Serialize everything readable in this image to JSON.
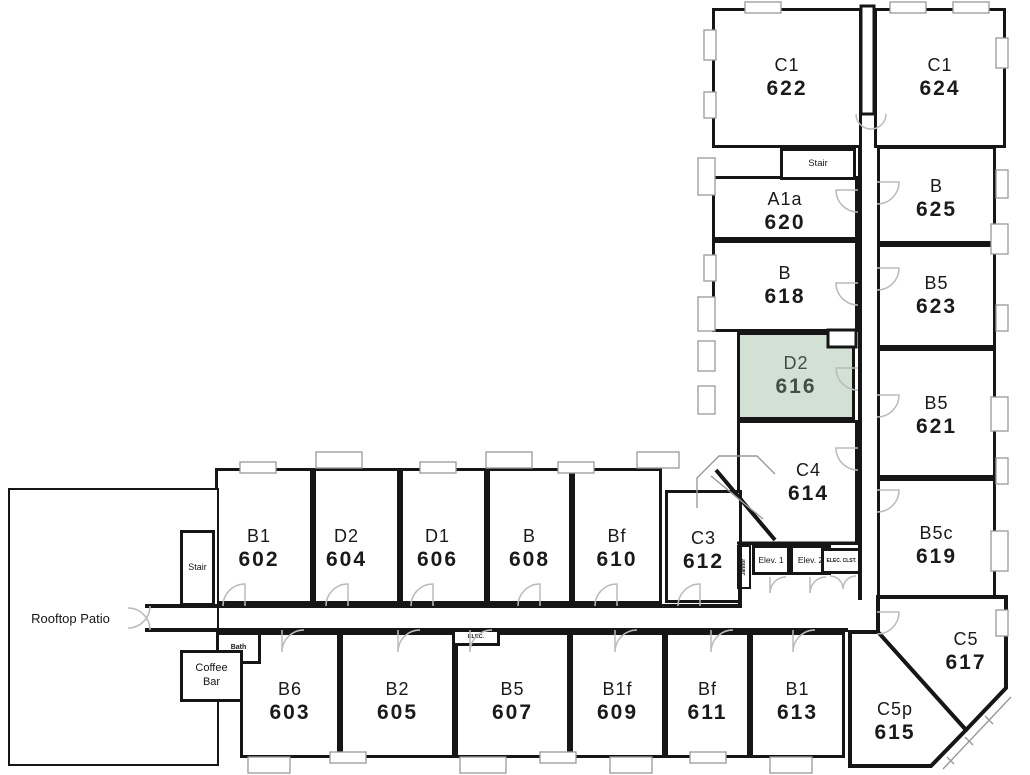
{
  "colors": {
    "wall": "#161616",
    "highlight_fill": "#d3e0d4",
    "highlight_text": "#3e5142",
    "room_text": "#1a1a1a",
    "door": "#bbbbbb",
    "window_frame": "#999999"
  },
  "plan": {
    "units": [
      {
        "type": "C1",
        "number": "622",
        "x": 712,
        "y": 8,
        "w": 150,
        "h": 140
      },
      {
        "type": "C1",
        "number": "624",
        "x": 874,
        "y": 8,
        "w": 132,
        "h": 140
      },
      {
        "type": "A1a",
        "number": "620",
        "x": 712,
        "y": 176,
        "w": 146,
        "h": 64,
        "dy": 4
      },
      {
        "type": "B",
        "number": "625",
        "x": 877,
        "y": 146,
        "w": 119,
        "h": 98,
        "dy": 4
      },
      {
        "type": "B",
        "number": "618",
        "x": 712,
        "y": 240,
        "w": 146,
        "h": 92
      },
      {
        "type": "B5",
        "number": "623",
        "x": 877,
        "y": 244,
        "w": 119,
        "h": 104
      },
      {
        "type": "D2",
        "number": "616",
        "x": 737,
        "y": 332,
        "w": 118,
        "h": 88,
        "highlighted": true
      },
      {
        "type": "B5",
        "number": "621",
        "x": 877,
        "y": 348,
        "w": 119,
        "h": 130,
        "dy": 3
      },
      {
        "type": "C4",
        "number": "614",
        "x": 737,
        "y": 420,
        "w": 121,
        "h": 125,
        "dx": 11
      },
      {
        "type": "B5c",
        "number": "619",
        "x": 877,
        "y": 478,
        "w": 119,
        "h": 120,
        "dy": 8
      },
      {
        "type": "C3",
        "number": "612",
        "x": 665,
        "y": 490,
        "w": 77,
        "h": 113,
        "dy": 4
      },
      {
        "type": "B1",
        "number": "602",
        "x": 215,
        "y": 468,
        "w": 98,
        "h": 136,
        "dx": -5,
        "dy": 13
      },
      {
        "type": "D2",
        "number": "604",
        "x": 313,
        "y": 468,
        "w": 87,
        "h": 136,
        "dx": -10,
        "dy": 13
      },
      {
        "type": "D1",
        "number": "606",
        "x": 400,
        "y": 468,
        "w": 87,
        "h": 136,
        "dx": -6,
        "dy": 13
      },
      {
        "type": "B",
        "number": "608",
        "x": 487,
        "y": 468,
        "w": 85,
        "h": 136,
        "dy": 13
      },
      {
        "type": "Bf",
        "number": "610",
        "x": 572,
        "y": 468,
        "w": 90,
        "h": 136,
        "dy": 13
      },
      {
        "type": "B6",
        "number": "603",
        "x": 240,
        "y": 632,
        "w": 100,
        "h": 126,
        "dy": 7
      },
      {
        "type": "B2",
        "number": "605",
        "x": 340,
        "y": 632,
        "w": 115,
        "h": 126,
        "dy": 7
      },
      {
        "type": "B5",
        "number": "607",
        "x": 455,
        "y": 632,
        "w": 115,
        "h": 126,
        "dy": 7
      },
      {
        "type": "B1f",
        "number": "609",
        "x": 570,
        "y": 632,
        "w": 95,
        "h": 126,
        "dy": 7
      },
      {
        "type": "Bf",
        "number": "611",
        "x": 665,
        "y": 632,
        "w": 85,
        "h": 126,
        "dy": 7
      },
      {
        "type": "B1",
        "number": "613",
        "x": 750,
        "y": 632,
        "w": 95,
        "h": 126,
        "dy": 7
      },
      {
        "type": "C5",
        "number": "617",
        "points": "878,597 1006,597 1006,688 966,730 878,634",
        "lx": 966,
        "ly": 652
      },
      {
        "type": "C5p",
        "number": "615",
        "points": "850,632 878,632 966,730 931,766 850,766",
        "lx": 895,
        "ly": 722
      }
    ],
    "services": [
      {
        "name": "rooftop-patio",
        "label": "Rooftop Patio",
        "x": 8,
        "y": 488,
        "w": 211,
        "h": 278,
        "font": 13,
        "border": 2,
        "dx": -43,
        "dy": -8
      },
      {
        "name": "stair-top",
        "label": "Stair",
        "x": 780,
        "y": 148,
        "w": 76,
        "h": 32,
        "font": 9.5,
        "border": 3
      },
      {
        "name": "stair-west",
        "label": "Stair",
        "x": 180,
        "y": 530,
        "w": 35,
        "h": 76,
        "font": 9,
        "border": 3
      },
      {
        "name": "elevator-1",
        "label": "Elev. 1",
        "x": 752,
        "y": 545,
        "w": 38,
        "h": 30,
        "font": 8.5,
        "border": 3
      },
      {
        "name": "elevator-2",
        "label": "Elev. 2",
        "x": 790,
        "y": 545,
        "w": 41,
        "h": 30,
        "font": 8.5,
        "border": 3
      },
      {
        "name": "elec-closet",
        "label": "ELEC. CLST.",
        "x": 821,
        "y": 548,
        "w": 41,
        "h": 26,
        "font": 5,
        "border": 3,
        "bold": true
      },
      {
        "name": "janitor",
        "label": "Janitor",
        "x": 737,
        "y": 545,
        "w": 14,
        "h": 44,
        "font": 5,
        "border": 2,
        "rotate": -90,
        "bold": true
      },
      {
        "name": "elec-room",
        "label": "ELEC.",
        "x": 452,
        "y": 628,
        "w": 48,
        "h": 18,
        "font": 5.5,
        "border": 3,
        "bold": true
      },
      {
        "name": "bath",
        "label": "Bath",
        "x": 216,
        "y": 632,
        "w": 45,
        "h": 32,
        "font": 7,
        "border": 3,
        "bold": true
      },
      {
        "name": "coffee-bar",
        "label": "Coffee\nBar",
        "x": 180,
        "y": 650,
        "w": 63,
        "h": 52,
        "font": 11,
        "border": 3
      }
    ]
  }
}
